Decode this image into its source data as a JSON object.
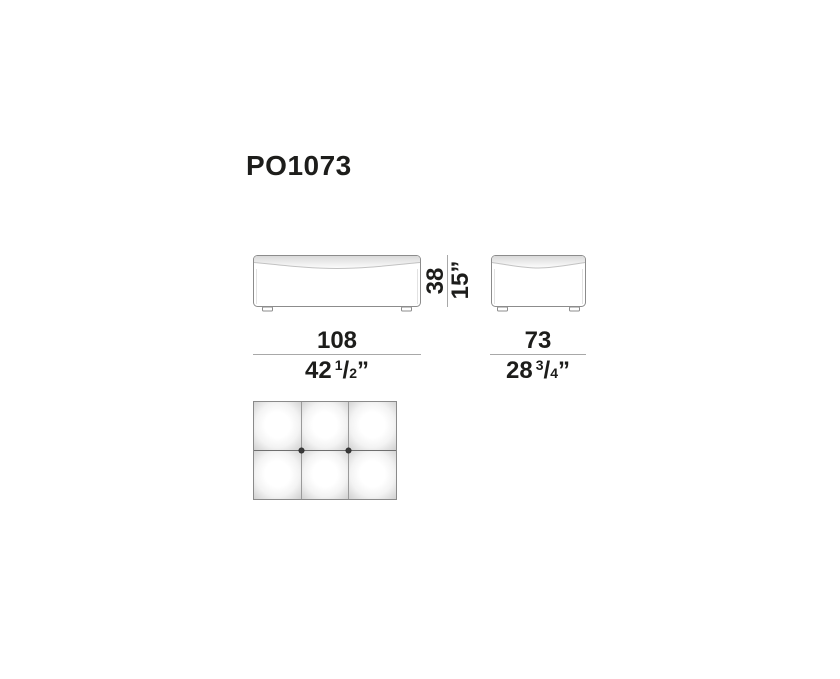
{
  "title": {
    "code": "PO1073"
  },
  "height_dim": {
    "cm": "38",
    "inches": "15”"
  },
  "width_dim": {
    "cm": "108",
    "in_whole": "42",
    "in_num": "1",
    "in_slash": "/",
    "in_den": "2",
    "in_mark": "”"
  },
  "depth_dim": {
    "cm": "73",
    "in_whole": "28",
    "in_num": "3",
    "in_slash": "/",
    "in_den": "4",
    "in_mark": "”"
  },
  "colors": {
    "text": "#1d1d1b",
    "drawing_outline": "#8c8c8c",
    "dimension_line": "#a8a8a8",
    "cushion_shade": "#c8c8c8",
    "tuft_button": "#3a3a3a"
  }
}
